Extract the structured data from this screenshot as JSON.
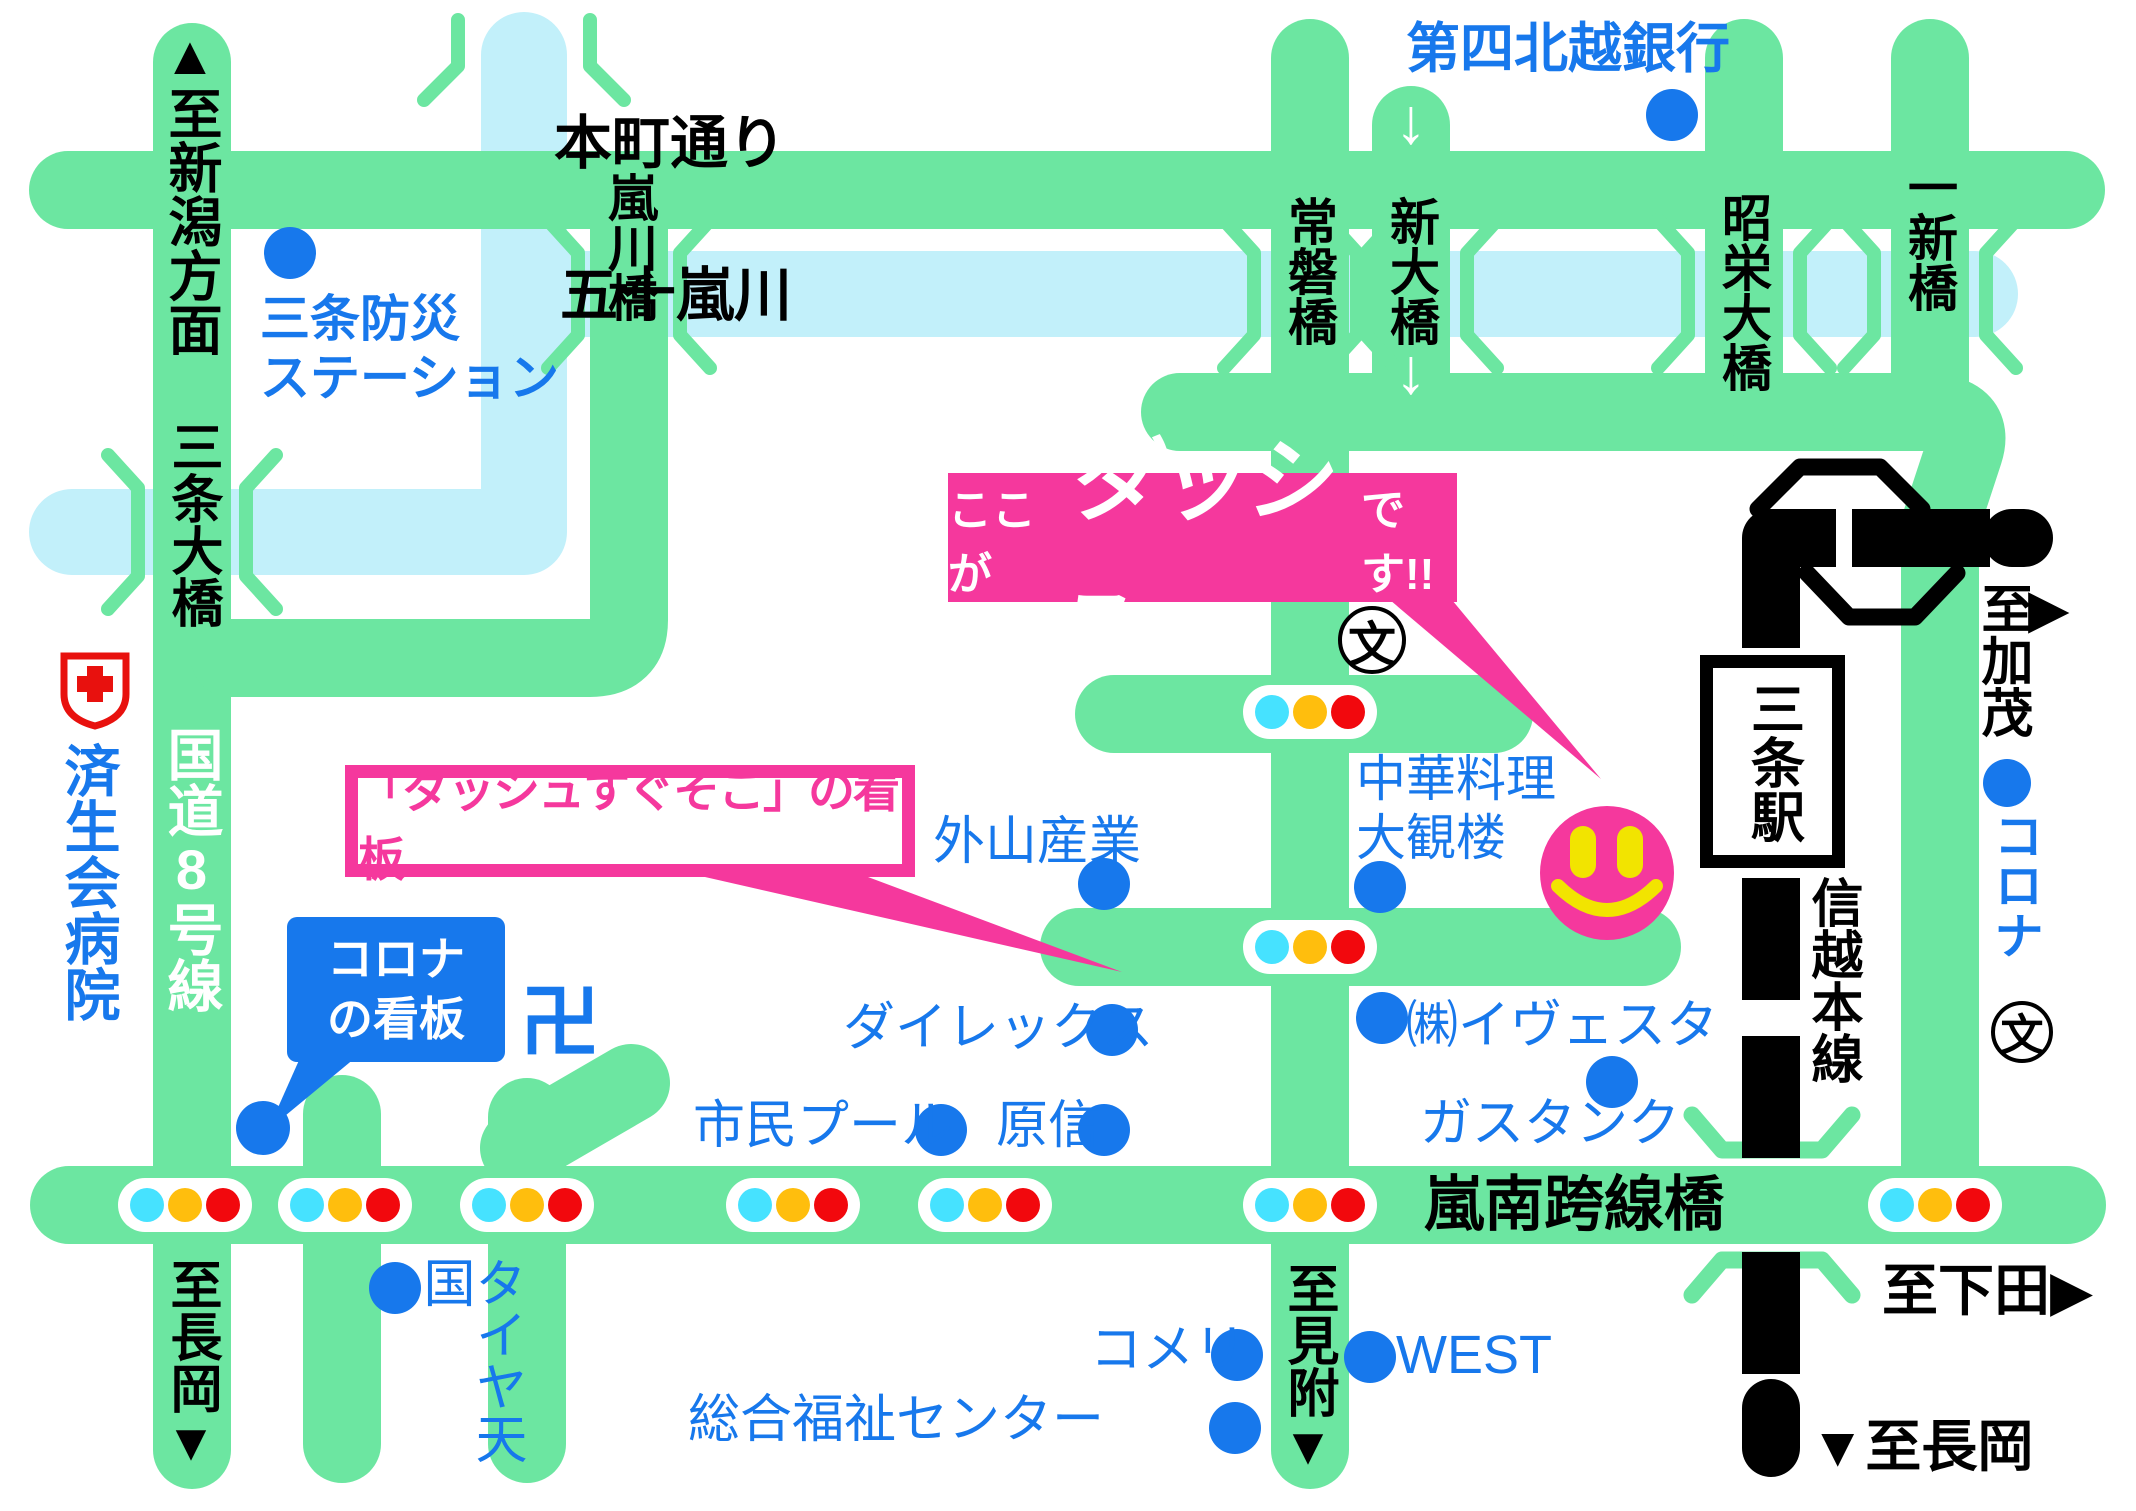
{
  "colors": {
    "road": "#6CE6A1",
    "river": "#C2F0FA",
    "rail": "#000000",
    "pink": "#F5389D",
    "poi_blue": "#1778EC",
    "label_blue": "#1778EC",
    "white": "#FFFFFF",
    "black": "#000000",
    "red_cross": "#E8110E",
    "tl_cyan": "#46E2FF",
    "tl_yellow": "#FFBE0D",
    "tl_red": "#F2080D",
    "smiley_yellow": "#F2E400"
  },
  "callout": {
    "prefix": "ここが",
    "brand": "ダッシュ",
    "suffix": "です!!"
  },
  "sign_callout": {
    "text": "「ダッシュすぐそこ」の看板"
  },
  "corona_sign": {
    "text": "コロナ\nの看板"
  },
  "station": {
    "name": "三条駅"
  },
  "white_arrows": [
    {
      "name": "shindai-bridge-down-arrow-top",
      "text": "↓",
      "x": 1384,
      "y": 84
    },
    {
      "name": "shindai-bridge-down-arrow-bottom",
      "text": "↓",
      "x": 1384,
      "y": 334
    }
  ],
  "labels": [
    {
      "name": "to-niigata",
      "text": "▲至新潟方面",
      "x": 163,
      "y": 26,
      "s": 54,
      "c": "black",
      "v": 1,
      "b": 1
    },
    {
      "name": "bosai-station",
      "text": "三条防災\nステーション",
      "x": 260,
      "y": 290,
      "s": 50,
      "c": "blue",
      "b": 1
    },
    {
      "name": "honcho-dori",
      "text": "本町通り",
      "x": 554,
      "y": 110,
      "s": 58,
      "c": "black",
      "b": 1
    },
    {
      "name": "ikarashi-river",
      "text": "五十嵐川",
      "x": 560,
      "y": 262,
      "s": 58,
      "c": "black",
      "b": 1
    },
    {
      "name": "arashikawa-bridge",
      "text": "嵐川橋",
      "x": 604,
      "y": 172,
      "s": 50,
      "c": "black",
      "v": 1,
      "b": 1
    },
    {
      "name": "tokiwa-bridge",
      "text": "常磐橋",
      "x": 1284,
      "y": 196,
      "s": 50,
      "c": "black",
      "v": 1,
      "b": 1
    },
    {
      "name": "shindai-bridge",
      "text": "新大橋",
      "x": 1386,
      "y": 196,
      "s": 50,
      "c": "black",
      "v": 1,
      "b": 1
    },
    {
      "name": "shoei-bridge",
      "text": "昭栄大橋",
      "x": 1718,
      "y": 192,
      "s": 50,
      "c": "black",
      "v": 1,
      "b": 1
    },
    {
      "name": "isshin-bridge",
      "text": "一新橋",
      "x": 1904,
      "y": 162,
      "s": 50,
      "c": "black",
      "v": 1,
      "b": 1
    },
    {
      "name": "daishi-hokuetsu-bank",
      "text": "第四北越銀行",
      "x": 1406,
      "y": 18,
      "s": 54,
      "c": "blue",
      "b": 1
    },
    {
      "name": "sanjo-ohashi-bridge",
      "text": "三条大橋",
      "x": 166,
      "y": 420,
      "s": 52,
      "c": "black",
      "v": 1,
      "b": 1
    },
    {
      "name": "saiseikai-hospital",
      "text": "済生会病院",
      "x": 60,
      "y": 742,
      "s": 56,
      "c": "blue",
      "v": 1,
      "b": 1
    },
    {
      "name": "route8",
      "text": "国道8号線",
      "x": 163,
      "y": 726,
      "s": 56,
      "c": "white",
      "v": 1,
      "b": 1
    },
    {
      "name": "to-kamo",
      "text": "至加茂",
      "x": 1976,
      "y": 582,
      "s": 52,
      "c": "black",
      "v": 1,
      "b": 1
    },
    {
      "name": "to-kamo-arrow",
      "text": "▶",
      "x": 2028,
      "y": 578,
      "s": 54,
      "c": "black",
      "b": 1
    },
    {
      "name": "corona-right",
      "text": "コロナ",
      "x": 1990,
      "y": 810,
      "s": 50,
      "c": "blue",
      "v": 1,
      "b": 1
    },
    {
      "name": "shinetsu-line",
      "text": "信越本線",
      "x": 1806,
      "y": 876,
      "s": 52,
      "c": "black",
      "v": 1,
      "b": 1
    },
    {
      "name": "to-shitada",
      "text": "至下田▶",
      "x": 1882,
      "y": 1258,
      "s": 56,
      "c": "black",
      "b": 1
    },
    {
      "name": "to-nagaoka-right",
      "text": "▼至長岡",
      "x": 1810,
      "y": 1414,
      "s": 56,
      "c": "black",
      "b": 1
    },
    {
      "name": "ransan-overpass",
      "text": "嵐南跨線橋",
      "x": 1424,
      "y": 1170,
      "s": 60,
      "c": "black",
      "b": 1
    },
    {
      "name": "to-mitsuke",
      "text": "至見附▼",
      "x": 1282,
      "y": 1262,
      "s": 52,
      "c": "black",
      "v": 1,
      "b": 1
    },
    {
      "name": "to-nagaoka-left",
      "text": "至長岡▼",
      "x": 165,
      "y": 1258,
      "s": 52,
      "c": "black",
      "v": 1,
      "b": 1
    },
    {
      "name": "chuka-taikanro",
      "text": "中華料理\n大観楼",
      "x": 1356,
      "y": 750,
      "s": 50,
      "c": "blue"
    },
    {
      "name": "toyama-sangyo",
      "text": "外山産業",
      "x": 933,
      "y": 812,
      "s": 52,
      "c": "blue"
    },
    {
      "name": "direx",
      "text": "ダイレックス",
      "x": 843,
      "y": 998,
      "s": 52,
      "c": "blue"
    },
    {
      "name": "shimin-pool",
      "text": "市民プール",
      "x": 693,
      "y": 1096,
      "s": 52,
      "c": "blue"
    },
    {
      "name": "harashin",
      "text": "原信",
      "x": 996,
      "y": 1096,
      "s": 52,
      "c": "blue"
    },
    {
      "name": "ivesta",
      "text": "㈱イヴェスタ",
      "x": 1406,
      "y": 996,
      "s": 52,
      "c": "blue"
    },
    {
      "name": "gas-tank",
      "text": "ガスタンク",
      "x": 1420,
      "y": 1094,
      "s": 52,
      "c": "blue"
    },
    {
      "name": "komeri",
      "text": "コメリ",
      "x": 1090,
      "y": 1320,
      "s": 52,
      "c": "blue"
    },
    {
      "name": "west",
      "text": "WEST",
      "x": 1396,
      "y": 1324,
      "s": 54,
      "c": "blue"
    },
    {
      "name": "sogo-fukushi-center",
      "text": "総合福祉センター",
      "x": 688,
      "y": 1390,
      "s": 52,
      "c": "blue"
    },
    {
      "name": "tire-tengoku",
      "text": "タイヤ天国",
      "x": 418,
      "y": 1256,
      "s": 52,
      "c": "blue",
      "v": 1
    },
    {
      "name": "manji-temple",
      "text": "卍",
      "x": 520,
      "y": 976,
      "s": 80,
      "c": "blue",
      "b": 1
    }
  ],
  "dots": [
    {
      "name": "dot-bosai-station",
      "x": 290,
      "y": 253
    },
    {
      "name": "dot-daishi-hokuetsu-bank",
      "x": 1672,
      "y": 115
    },
    {
      "name": "dot-toyama-sangyo",
      "x": 1104,
      "y": 884
    },
    {
      "name": "dot-chuka-taikanro",
      "x": 1380,
      "y": 887
    },
    {
      "name": "dot-direx",
      "x": 1112,
      "y": 1030
    },
    {
      "name": "dot-shimin-pool",
      "x": 941,
      "y": 1130
    },
    {
      "name": "dot-harashin",
      "x": 1104,
      "y": 1130
    },
    {
      "name": "dot-ivesta",
      "x": 1382,
      "y": 1018
    },
    {
      "name": "dot-gas-tank",
      "x": 1612,
      "y": 1082
    },
    {
      "name": "dot-komeri",
      "x": 1237,
      "y": 1355
    },
    {
      "name": "dot-west",
      "x": 1370,
      "y": 1357
    },
    {
      "name": "dot-sogo-fukushi-center",
      "x": 1235,
      "y": 1428
    },
    {
      "name": "dot-tire-tengoku",
      "x": 395,
      "y": 1288
    },
    {
      "name": "dot-corona-right",
      "x": 2007,
      "y": 783,
      "r": 24
    },
    {
      "name": "dot-corona-sign",
      "x": 263,
      "y": 1128,
      "r": 27
    }
  ],
  "traffic_lights": [
    {
      "x": 185,
      "y": 1205
    },
    {
      "x": 345,
      "y": 1205
    },
    {
      "x": 527,
      "y": 1205
    },
    {
      "x": 793,
      "y": 1205
    },
    {
      "x": 985,
      "y": 1205
    },
    {
      "x": 1310,
      "y": 1205
    },
    {
      "x": 1935,
      "y": 1205
    },
    {
      "x": 1310,
      "y": 712
    },
    {
      "x": 1310,
      "y": 947
    }
  ],
  "school_symbols": [
    {
      "name": "school-symbol-center",
      "char": "文",
      "x": 1372,
      "y": 640,
      "r": 34
    },
    {
      "name": "school-symbol-right",
      "char": "文",
      "x": 2022,
      "y": 1032,
      "r": 31
    }
  ]
}
